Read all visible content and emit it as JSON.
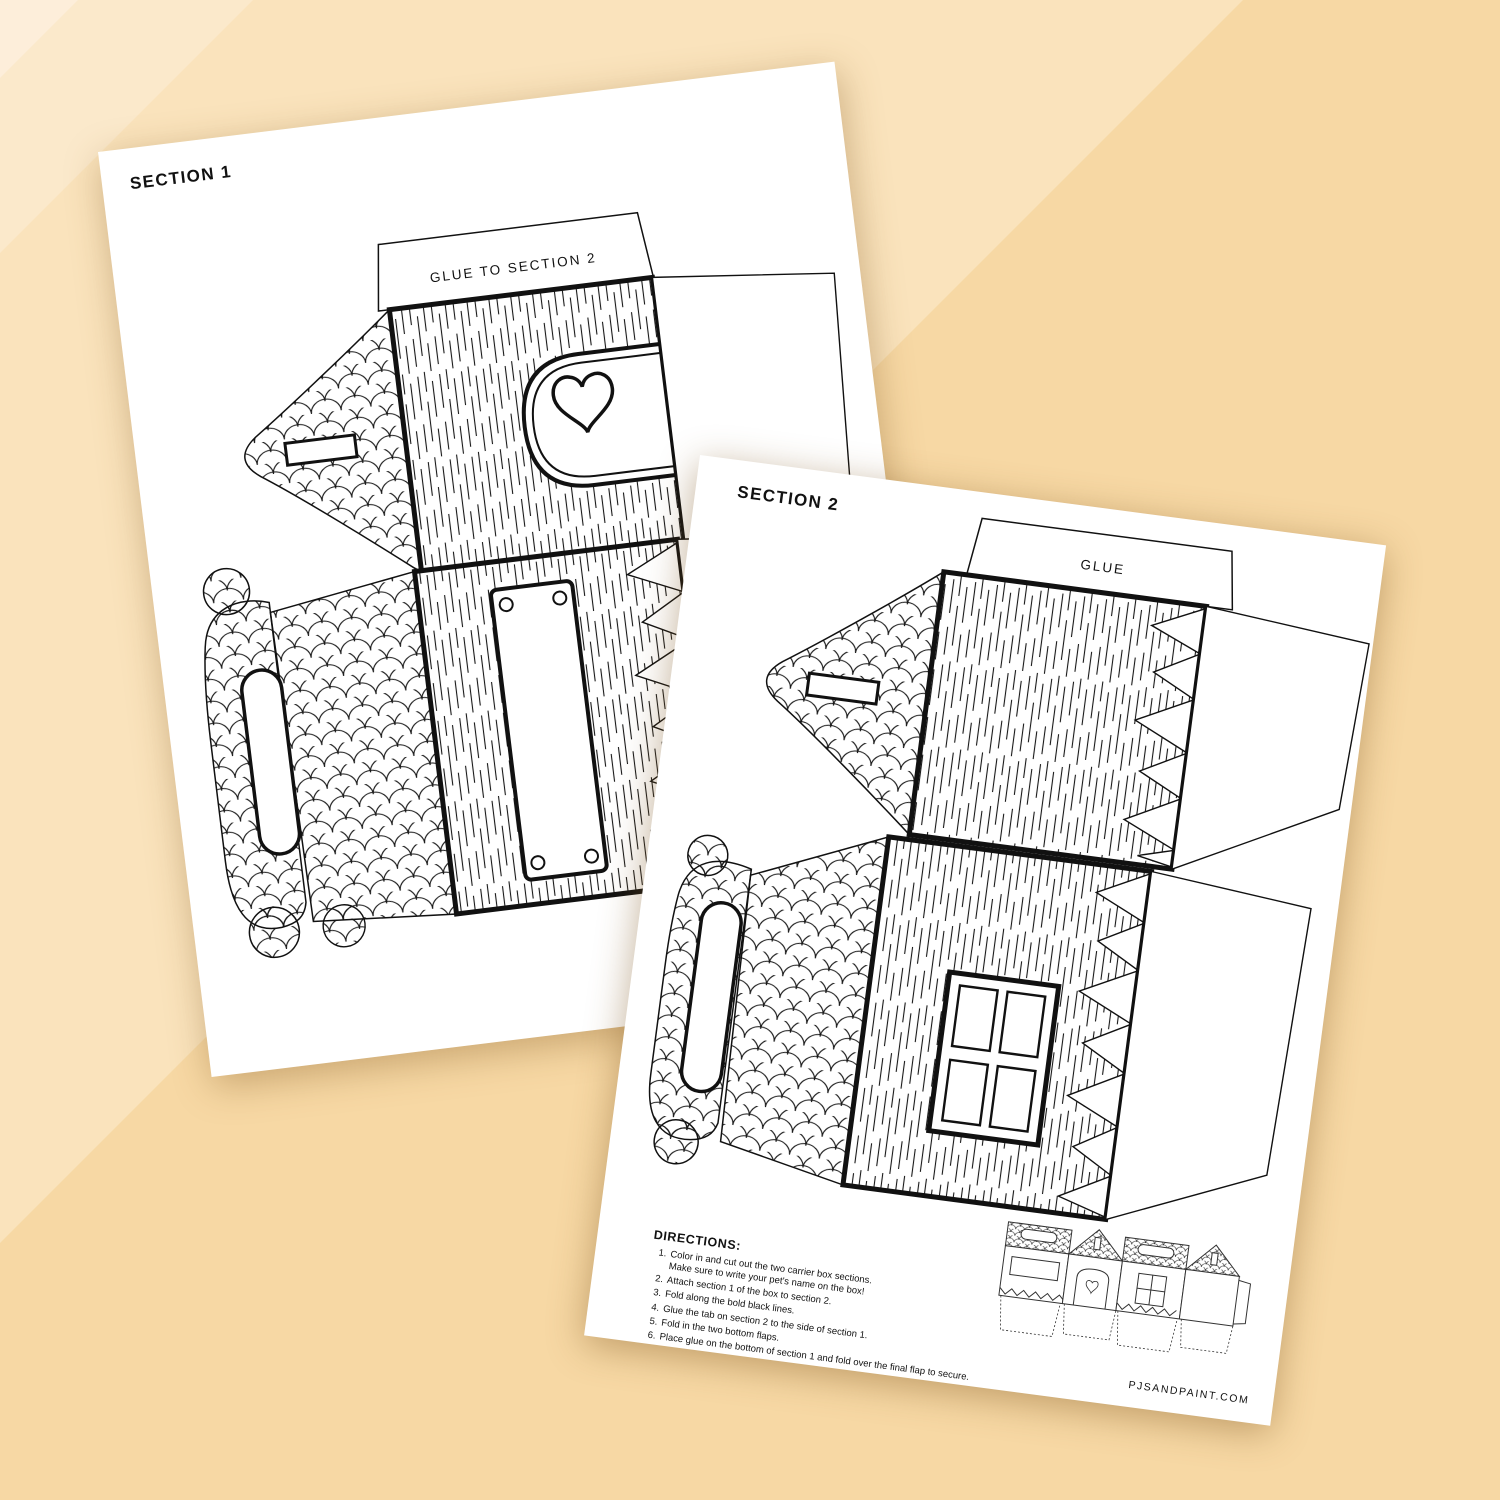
{
  "colors": {
    "bg_base": "#f7d8a4",
    "bg_band": "#fae3bc",
    "bg_corner": "#fbe9cb",
    "bg_corner2": "#fdeeda",
    "paper": "#ffffff",
    "ink": "#111111"
  },
  "page1": {
    "title": "SECTION 1",
    "tab_label": "GLUE TO SECTION 2"
  },
  "page2": {
    "title": "SECTION 2",
    "tab_label": "GLUE",
    "website": "PJSANDPAINT.COM",
    "directions": {
      "title": "DIRECTIONS:",
      "items": [
        {
          "num": "1.",
          "text": "Color in and cut out the two carrier box sections.",
          "text2": "Make sure to write your pet's name on the box!"
        },
        {
          "num": "2.",
          "text": "Attach section 1 of the box to section 2."
        },
        {
          "num": "3.",
          "text": "Fold along the bold black lines."
        },
        {
          "num": "4.",
          "text": "Glue the tab on section 2 to the side of section 1."
        },
        {
          "num": "5.",
          "text": "Fold in the two bottom flaps."
        },
        {
          "num": "6.",
          "text": "Place glue on the bottom of section 1 and fold over the final flap to secure."
        }
      ]
    }
  }
}
